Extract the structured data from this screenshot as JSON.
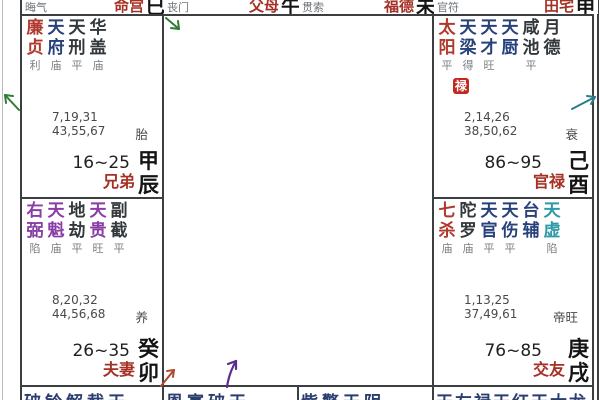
{
  "colors": {
    "red": "#b0392e",
    "navy": "#27427b",
    "purple": "#8a3da6",
    "teal": "#2e9aa8",
    "dark": "#33383c"
  },
  "top_row": [
    {
      "god": "晦气",
      "palace": "命宫",
      "branch": "巳"
    },
    {
      "god": "丧门",
      "palace": "父母",
      "branch": "午"
    },
    {
      "god": "贯索",
      "palace": "福德",
      "branch": "未"
    },
    {
      "god": "官符",
      "palace": "田宅",
      "branch": "申"
    }
  ],
  "palaces": [
    {
      "name": "兄弟",
      "stem": "甲",
      "branch": "辰",
      "decade": "16~25",
      "stage": "胎",
      "numbers": [
        "7,19,31",
        "43,55,67"
      ],
      "gods": [
        "喜神",
        "华盖",
        "岁建"
      ],
      "stars": [
        {
          "name": "廉贞",
          "state": "利",
          "color": "red"
        },
        {
          "name": "天府",
          "state": "庙",
          "color": "navy"
        },
        {
          "name": "天刑",
          "state": "平",
          "color": "dark"
        },
        {
          "name": "华盖",
          "state": "庙",
          "color": "dark"
        }
      ]
    },
    {
      "name": "夫妻",
      "stem": "癸",
      "branch": "卯",
      "decade": "26~35",
      "stage": "养",
      "numbers": [
        "8,20,32",
        "44,56,68"
      ],
      "gods": [
        "病符",
        "息神",
        "病符"
      ],
      "stars": [
        {
          "name": "右弼",
          "state": "陷",
          "color": "purple"
        },
        {
          "name": "天魁",
          "state": "庙",
          "color": "purple"
        },
        {
          "name": "地劫",
          "state": "平",
          "color": "dark"
        },
        {
          "name": "天贵",
          "state": "旺",
          "color": "purple"
        },
        {
          "name": "副截",
          "state": "平",
          "color": "dark"
        }
      ]
    },
    {
      "name": "官禄",
      "stem": "己",
      "branch": "酉",
      "decade": "86~95",
      "stage": "衰",
      "numbers": [
        "2,14,26",
        "38,50,62"
      ],
      "gods": [
        "青龙",
        "咸池",
        "小耗"
      ],
      "hua": {
        "label": "禄"
      },
      "stars": [
        {
          "name": "太阳",
          "state": "平",
          "color": "red"
        },
        {
          "name": "天梁",
          "state": "得",
          "color": "navy"
        },
        {
          "name": "天才",
          "state": "旺",
          "color": "navy"
        },
        {
          "name": "天厨",
          "state": "",
          "color": "navy"
        },
        {
          "name": "咸池",
          "state": "平",
          "color": "dark"
        },
        {
          "name": "月德",
          "state": "",
          "color": "dark"
        }
      ]
    },
    {
      "name": "交友",
      "stem": "庚",
      "branch": "戌",
      "decade": "76~85",
      "stage": "帝旺",
      "numbers": [
        "1,13,25",
        "37,49,61"
      ],
      "gods": [
        "力士",
        "月煞",
        "岁破"
      ],
      "stars": [
        {
          "name": "七杀",
          "state": "庙",
          "color": "red"
        },
        {
          "name": "陀罗",
          "state": "庙",
          "color": "dark"
        },
        {
          "name": "天官",
          "state": "平",
          "color": "navy"
        },
        {
          "name": "天伤",
          "state": "平",
          "color": "navy"
        },
        {
          "name": "台辅",
          "state": "",
          "color": "navy"
        },
        {
          "name": "天虚",
          "state": "陷",
          "color": "teal"
        }
      ]
    }
  ],
  "bottom_row": [
    {
      "partial_stars": "破铃解截天"
    },
    {
      "partial_stars": "恩寡破天"
    },
    {
      "partial_stars": "紫擎天阴"
    },
    {
      "partial_stars": "天左禄天红天大龙"
    }
  ]
}
